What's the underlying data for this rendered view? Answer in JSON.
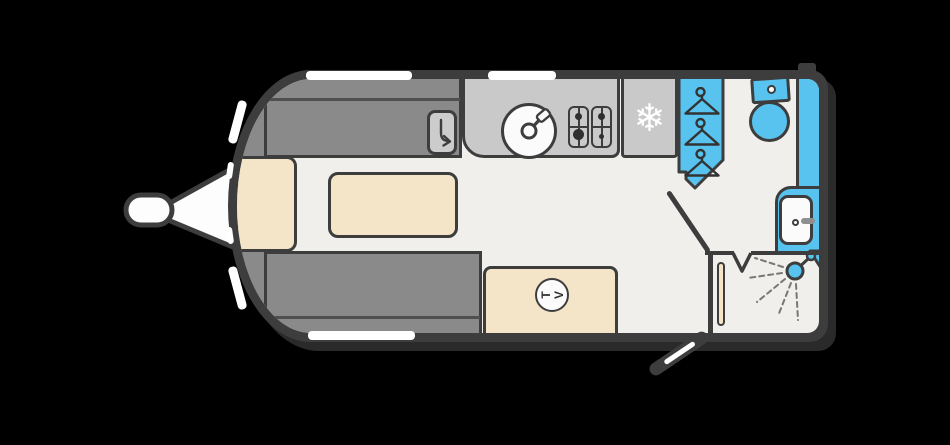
{
  "diagram": {
    "type": "caravan-floorplan",
    "orientation": "hitch-left",
    "areas": [
      "front-lounge",
      "kitchen",
      "wardrobe",
      "washroom",
      "entrance"
    ]
  },
  "canvas": {
    "width": 950,
    "height": 445,
    "background": "#000000"
  },
  "colors": {
    "outline": "#3d3d3d",
    "floor": "#f0efec",
    "sofa_grey": "#8a8a8a",
    "worktop_grey": "#c9c9c9",
    "upholstery_cream": "#f4e4c8",
    "wet_area_blue": "#58c3ee",
    "window_white": "#ffffff"
  },
  "labels": {
    "tv": "TV"
  },
  "icons": {
    "snowflake_glyph": "❄",
    "fridge": "snowflake-icon",
    "wardrobe": "coat-hangers-icon",
    "sink": "round-sink-with-tap-icon",
    "hob": "four-burner-hob-icon",
    "shower": "shower-head-with-spray-icon",
    "storage": "curved-arrow-icon",
    "tv": "tv-circle-badge"
  }
}
